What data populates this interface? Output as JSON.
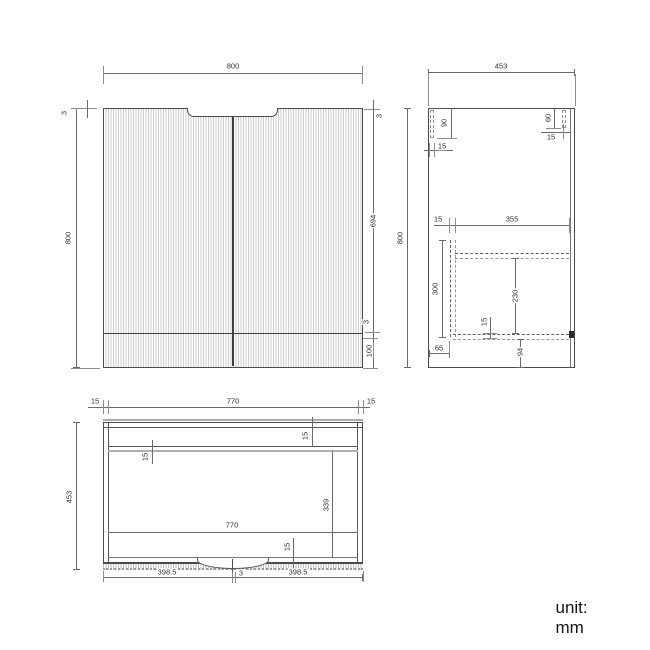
{
  "unit_label": "unit: mm",
  "dims": {
    "front": {
      "width": "800",
      "height": "800",
      "reveal_left": "3",
      "reveal_right": "3",
      "door_height": "694",
      "gap": "3",
      "drawer_front": "100"
    },
    "side": {
      "depth": "453",
      "height": "800",
      "back_rail": "90",
      "back_panel": "15",
      "front_rail": "60",
      "front_panel": "15",
      "drawer_back": "15",
      "drawer_depth": "355",
      "drawer_height": "300",
      "shelf_clear": "230",
      "bottom_panel": "15",
      "back_offset": "65",
      "bottom_clear": "94"
    },
    "plan": {
      "panel_left": "15",
      "inner_width": "770",
      "panel_right": "15",
      "depth": "453",
      "back_panel": "15",
      "rail": "15",
      "inner_depth": "339",
      "inner_width_2": "770",
      "door_panel": "15",
      "door_left": "398.5",
      "center_gap": "3",
      "door_right": "398.5"
    }
  }
}
